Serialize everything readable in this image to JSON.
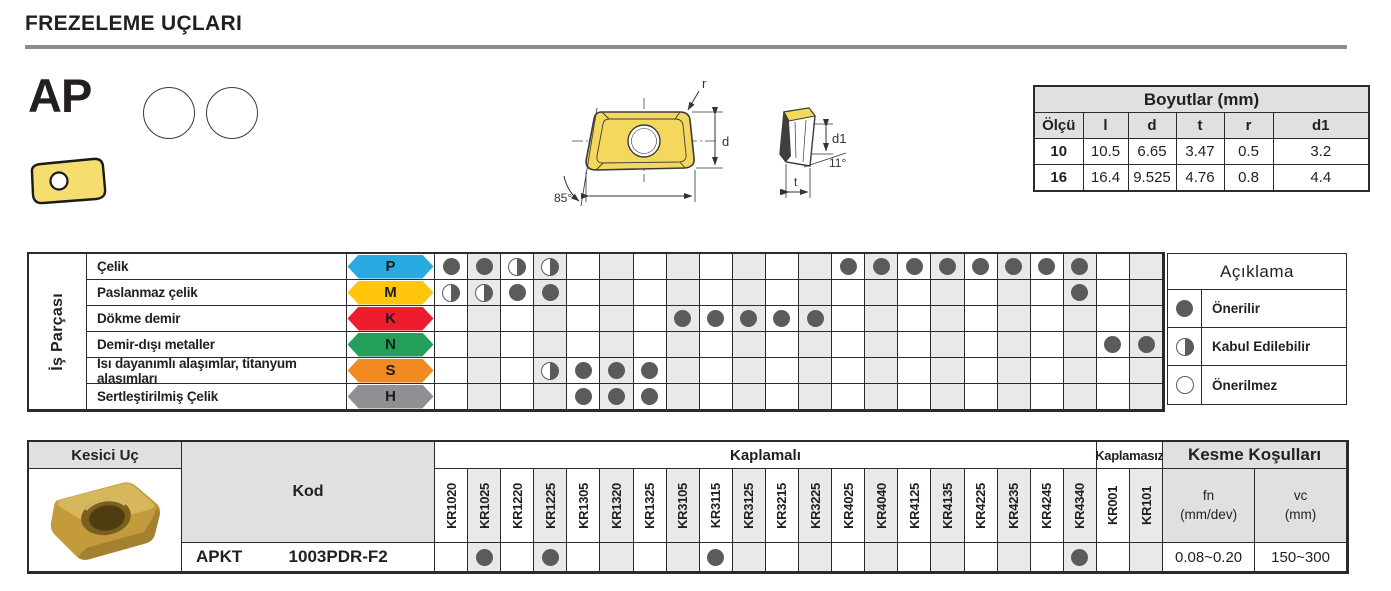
{
  "page": {
    "title": "FREZELEME UÇLARI"
  },
  "product": {
    "series": "AP",
    "shape_circles": 2
  },
  "drawing": {
    "labels": {
      "radius": "r",
      "diameter": "d",
      "hole_diameter": "d1",
      "thickness": "t",
      "corner_angle": "85°",
      "clearance_angle": "11°"
    }
  },
  "dimensions_table": {
    "title": "Boyutlar (mm)",
    "columns": [
      "Ölçü",
      "l",
      "d",
      "t",
      "r",
      "d1"
    ],
    "rows": [
      [
        "10",
        "10.5",
        "6.65",
        "3.47",
        "0.5",
        "3.2"
      ],
      [
        "16",
        "16.4",
        "9.525",
        "4.76",
        "0.8",
        "4.4"
      ]
    ]
  },
  "workpiece_table": {
    "side_label": "İş Parçası",
    "grades": [
      "KR1020",
      "KR1025",
      "KR1220",
      "KR1225",
      "KR1305",
      "KR1320",
      "KR1325",
      "KR3105",
      "KR3115",
      "KR3125",
      "KR3215",
      "KR3225",
      "KR4025",
      "KR4040",
      "KR4125",
      "KR4135",
      "KR4225",
      "KR4235",
      "KR4245",
      "KR4340",
      "KR001",
      "KR101"
    ],
    "rows": [
      {
        "label": "Çelik",
        "iso": "P",
        "color": "#29abe2",
        "marks": [
          "full",
          "full",
          "half",
          "half",
          "",
          "",
          "",
          "",
          "",
          "",
          "",
          "",
          "full",
          "full",
          "full",
          "full",
          "full",
          "full",
          "full",
          "full",
          "",
          ""
        ]
      },
      {
        "label": "Paslanmaz çelik",
        "iso": "M",
        "color": "#ffc60b",
        "marks": [
          "half",
          "half",
          "full",
          "full",
          "",
          "",
          "",
          "",
          "",
          "",
          "",
          "",
          "",
          "",
          "",
          "",
          "",
          "",
          "",
          "full",
          "",
          ""
        ]
      },
      {
        "label": "Dökme demir",
        "iso": "K",
        "color": "#ed1c2e",
        "marks": [
          "",
          "",
          "",
          "",
          "",
          "",
          "",
          "full",
          "full",
          "full",
          "full",
          "full",
          "",
          "",
          "",
          "",
          "",
          "",
          "",
          "",
          "",
          ""
        ]
      },
      {
        "label": "Demir-dışı metaller",
        "iso": "N",
        "color": "#22a05a",
        "marks": [
          "",
          "",
          "",
          "",
          "",
          "",
          "",
          "",
          "",
          "",
          "",
          "",
          "",
          "",
          "",
          "",
          "",
          "",
          "",
          "",
          "full",
          "full"
        ]
      },
      {
        "label": "Isı dayanımlı alaşımlar, titanyum alaşımları",
        "iso": "S",
        "color": "#f18a21",
        "marks": [
          "",
          "",
          "",
          "half",
          "full",
          "full",
          "full",
          "",
          "",
          "",
          "",
          "",
          "",
          "",
          "",
          "",
          "",
          "",
          "",
          "",
          "",
          ""
        ]
      },
      {
        "label": "Sertleştirilmiş Çelik",
        "iso": "H",
        "color": "#8f9093",
        "marks": [
          "",
          "",
          "",
          "",
          "full",
          "full",
          "full",
          "",
          "",
          "",
          "",
          "",
          "",
          "",
          "",
          "",
          "",
          "",
          "",
          "",
          "",
          ""
        ]
      }
    ]
  },
  "legend": {
    "title": "Açıklama",
    "items": [
      {
        "symbol": "full",
        "label": "Önerilir"
      },
      {
        "symbol": "half",
        "label": "Kabul Edilebilir"
      },
      {
        "symbol": "none",
        "label": "Önerilmez"
      }
    ]
  },
  "insert_table": {
    "header_left": "Kesici Uç",
    "kod_label": "Kod",
    "coated_label": "Kaplamalı",
    "uncoated_label": "Kaplamasız",
    "cutting_label": "Kesme Koşulları",
    "fn_label": [
      "fn",
      "(mm/dev)"
    ],
    "vc_label": [
      "vc",
      "(mm)"
    ],
    "row": {
      "code_prefix": "APKT",
      "code_suffix": "1003PDR-F2",
      "marks": [
        "",
        "full",
        "",
        "full",
        "",
        "",
        "",
        "",
        "full",
        "",
        "",
        "",
        "",
        "",
        "",
        "",
        "",
        "",
        "",
        "full",
        "",
        ""
      ],
      "fn": "0.08~0.20",
      "vc": "150~300"
    }
  }
}
